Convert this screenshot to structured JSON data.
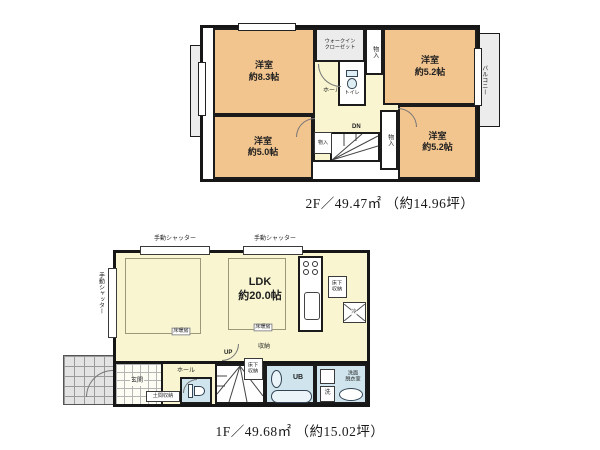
{
  "colors": {
    "wall": "#161616",
    "room_orange": "#f2c48e",
    "room_yellow": "#f8f5d0",
    "room_blue": "#cfe4ec",
    "balcony_gray": "#ececec"
  },
  "floor2": {
    "caption": "2F／49.47㎡ （約14.96坪）",
    "balcony_left": "バルコニー",
    "balcony_right": "バルコニー",
    "bedroom_nw": "洋室\n約8.3帖",
    "bedroom_ne": "洋室\n約5.2帖",
    "bedroom_sw": "洋室\n約5.0帖",
    "bedroom_se": "洋室\n約5.2帖",
    "wic": "ウォークイン\nクローゼット",
    "closet_top": "物入",
    "closet_mid": "物入",
    "closet_right": "物入",
    "toilet": "トイレ",
    "hall": "ホール",
    "stairs_dn": "DN"
  },
  "floor1": {
    "caption": "1F／49.68㎡ （約15.02坪）",
    "shutter": "手動シャッター",
    "ldk": "LDK\n約20.0帖",
    "floor_heating": "床暖房",
    "underfloor_storage": "床下\n収納",
    "fridge": "冷",
    "genkan": "玄関",
    "hall": "ホール",
    "doma_storage": "土間収納",
    "stairs_up": "UP",
    "closet": "収納",
    "ub": "UB",
    "washroom": "洗面\n脱衣室",
    "washer": "洗"
  }
}
